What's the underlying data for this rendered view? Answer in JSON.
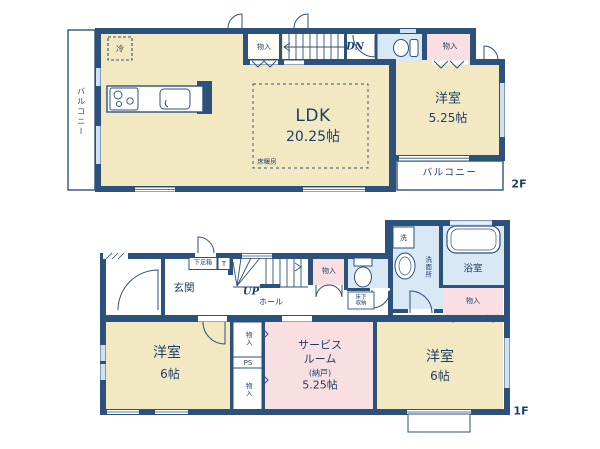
{
  "plan_title": "2-story house floor plan",
  "colors": {
    "wall": "#2c527b",
    "room_cream": "#f2e9c2",
    "closet_pink": "#f9dee2",
    "wet_blue": "#d9e8f5",
    "text_navy": "#1d3f66",
    "window_blue": "#cfe2f2"
  },
  "floor2": {
    "floor_label": "2F",
    "balcony_left": "バルコニー",
    "balcony_bottom": "バルコニー",
    "closet_top_left": "物入",
    "closet_top_right": "物入",
    "stairs_direction": "DN",
    "fridge": "冷",
    "ldk": {
      "name": "LDK",
      "size": "20.25帖"
    },
    "floor_heating": "床暖房",
    "bedroom": {
      "name": "洋室",
      "size": "5.25帖"
    }
  },
  "floor1": {
    "floor_label": "1F",
    "entrance": "玄関",
    "shoe_box": "下足箱",
    "t_box": "T",
    "stairs_direction": "UP",
    "hall": "ホール",
    "closet_hall": "物入",
    "underfloor_storage": "床下\n収納",
    "washer": "洗",
    "washroom": "洗面所",
    "bathroom": "浴室",
    "closet_bath": "物入",
    "bedroom_left": {
      "name": "洋室",
      "size": "6帖"
    },
    "closet_small_top": "物入",
    "pipe_space": "PS",
    "closet_small_bottom": "物入",
    "service_room": {
      "line1": "サービス",
      "line2": "ルーム",
      "line3": "(納戸)",
      "line4": "5.25帖"
    },
    "bedroom_right": {
      "name": "洋室",
      "size": "6帖"
    }
  }
}
